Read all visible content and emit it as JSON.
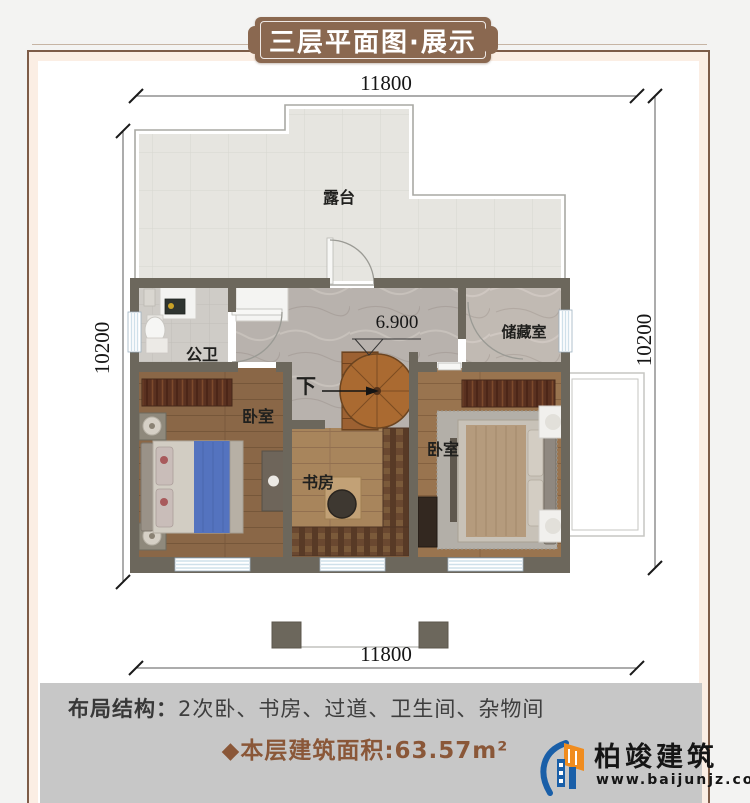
{
  "banner": {
    "title": "三层平面图·展示"
  },
  "dimensions": {
    "top": "11800",
    "bottom": "11800",
    "left": "10200",
    "right": "10200"
  },
  "plan": {
    "terrace_label": "露台",
    "bathroom_label": "公卫",
    "storage_label": "储藏室",
    "bedroom_left_label": "卧室",
    "bedroom_right_label": "卧室",
    "study_label": "书房",
    "stairs_down_label": "下",
    "level_label": "6.900"
  },
  "footer": {
    "layout_label": "布局结构：",
    "layout_value": "2次卧、书房、过道、卫生间、杂物间",
    "area_text": "◆本层建筑面积:63.57m²",
    "logo_name": "柏竣建筑",
    "logo_url": "www.baijunjz.com"
  },
  "colors": {
    "banner_brown": "#8a6850",
    "area_text_brown": "#8a5738",
    "wall": "#6c675c",
    "terrace_tile": "#e6e5e0",
    "marble_floor": "#b8b2ad",
    "wood_floor": "#8a6747",
    "logo_blue": "#1a5fa8",
    "logo_orange": "#f08c1e",
    "footer_band": "#c7c7c7"
  }
}
